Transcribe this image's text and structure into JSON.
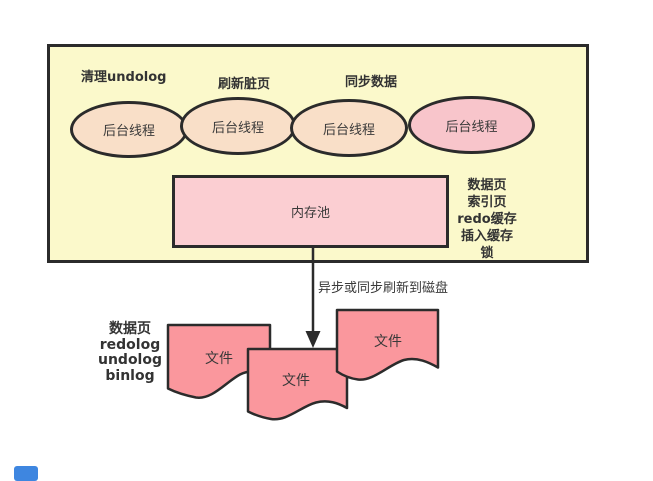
{
  "colors": {
    "background": "#ffffff",
    "box_fill": "#fbf9cb",
    "thread_fill_peach": "#f9dfc8",
    "thread_fill_pink": "#f8c5cb",
    "pool_fill": "#fbced2",
    "file_fill": "#fa979d",
    "stroke": "#2b2b2b",
    "text": "#333333",
    "blue_mark": "#3e86e0"
  },
  "buffer_box": {
    "task_labels": [
      "清理undolog",
      "刷新脏页",
      "同步数据"
    ],
    "threads": [
      "后台线程",
      "后台线程",
      "后台线程",
      "后台线程"
    ],
    "memory_pool_label": "内存池",
    "pool_contents": [
      "数据页",
      "索引页",
      "redo缓存",
      "插入缓存",
      "锁"
    ]
  },
  "flush": {
    "arrow_label": "异步或同步刷新到磁盘"
  },
  "disk": {
    "file_types": [
      "数据页",
      "redolog",
      "undolog",
      "binlog"
    ],
    "files": [
      "文件",
      "文件",
      "文件"
    ]
  }
}
